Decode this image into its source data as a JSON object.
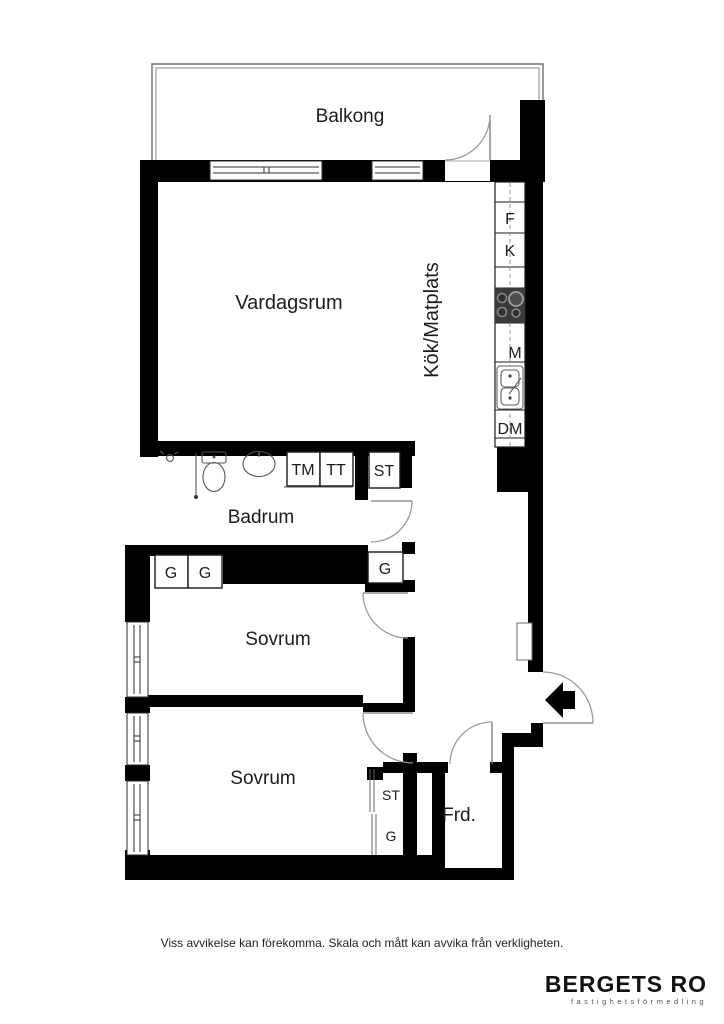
{
  "floor_plan": {
    "rooms": {
      "balcony": {
        "label": "Balkong"
      },
      "living_room": {
        "label": "Vardagsrum"
      },
      "kitchen": {
        "label": "Kök/Matplats"
      },
      "bathroom": {
        "label": "Badrum"
      },
      "bedroom_1": {
        "label": "Sovrum"
      },
      "bedroom_2": {
        "label": "Sovrum"
      },
      "storage": {
        "label": "Frd."
      }
    },
    "fixtures": {
      "freezer": "F",
      "fridge": "K",
      "microwave": "M",
      "dishwasher": "DM",
      "washing_machine": "TM",
      "tumble_dryer": "TT",
      "cleaning_closet_hall": "ST",
      "wardrobe_bedroom1_a": "G",
      "wardrobe_bedroom1_b": "G",
      "wardrobe_hall": "G",
      "cleaning_closet_bedroom2": "ST",
      "wardrobe_bedroom2": "G"
    }
  },
  "footer": {
    "disclaimer": "Viss avvikelse kan förekomma. Skala och mått kan avvika från verkligheten."
  },
  "brand": {
    "name": "BERGETS RO",
    "tagline": "fastighetsförmedling"
  },
  "colors": {
    "wall": "#000000",
    "thin_line": "#777777",
    "door_arc": "#9a9a9a",
    "stove": "#3a3a3a"
  }
}
